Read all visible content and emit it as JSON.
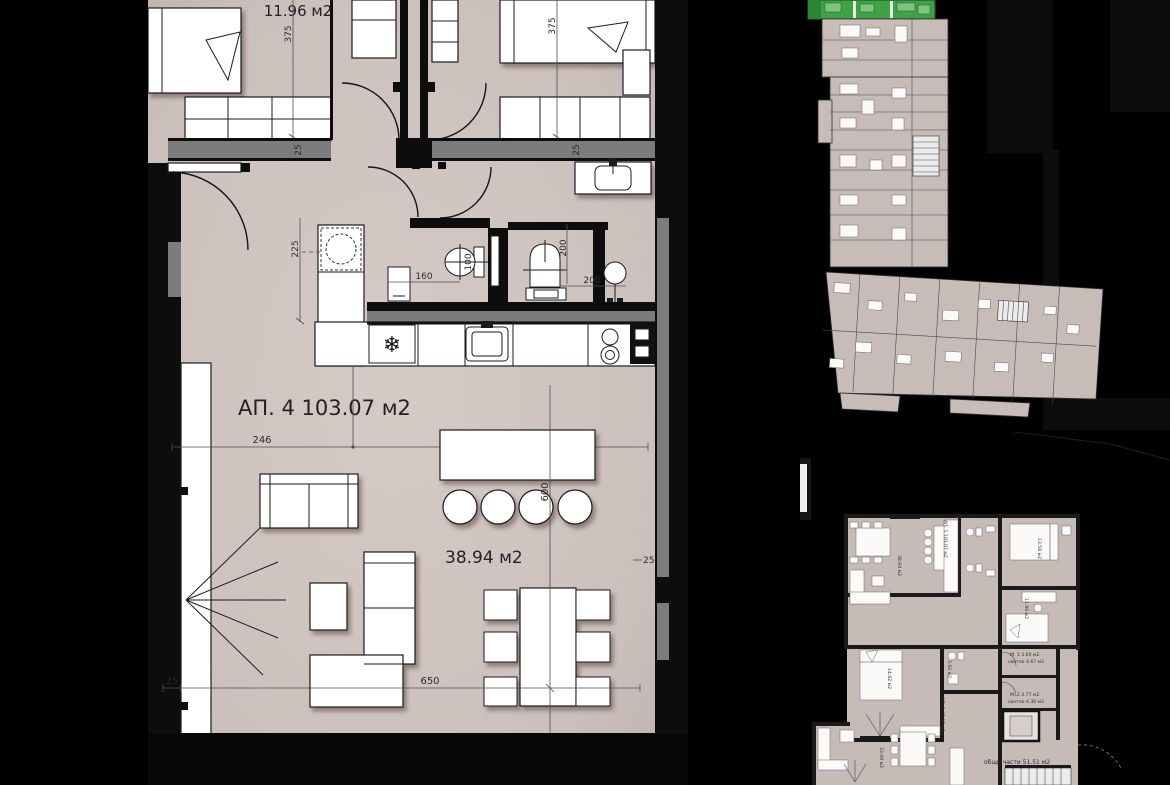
{
  "colors": {
    "background": "#000000",
    "floor": "#cdc1bd",
    "wall_gray": "#7c7c7c",
    "wall_black": "#0d0d0d",
    "furniture": "#ffffff",
    "highlight_green": "#3fa246",
    "highlight_green_dark": "#236a2a",
    "highlight_green_light": "#7cc47f",
    "small_plan_floor": "#c7bbb7"
  },
  "icons": {
    "snowflake": "❄"
  },
  "main_plan": {
    "apartment_label": "АП. 4 103.07 м2",
    "living_area_label": "38.94 м2",
    "bedroom_area_label": "11.96 м2",
    "dims": {
      "bedroom_left_height": "375",
      "bedroom_right_height": "375",
      "wall_top_left": "25",
      "wall_top_right": "25",
      "hall_depth": "225",
      "wc_width": "160",
      "wc_depth": "100",
      "bath_height": "200",
      "bath_width": "200",
      "living_seg_left": "246",
      "living_seg_right": "402",
      "living_height": "600",
      "living_width": "650",
      "wall_bottom_left": "25",
      "wall_mid_right": "25"
    }
  },
  "key_plan": {
    "apt1_label": "АП. 1 103.07 м2",
    "apt1_living_label": "38.94 м2",
    "apt1_bedroom_top_label": "13.58 м2",
    "apt1_bedroom_bottom_label": "11.96 м2",
    "bedroom_left_label": "14.62 м2",
    "bath_label": "3.92 м2",
    "apt2_label": "АП. 2 67.97 м2",
    "apt2_living_label": "33.09 м2",
    "storage1_line1": "М. 1 3.60 м2",
    "storage1_line2": "светло 4.67 м2",
    "storage2_line1": "М. 2 3.77 м2",
    "storage2_line2": "светло 4.30 м2",
    "common_label": "общи части 51.51 м2"
  }
}
